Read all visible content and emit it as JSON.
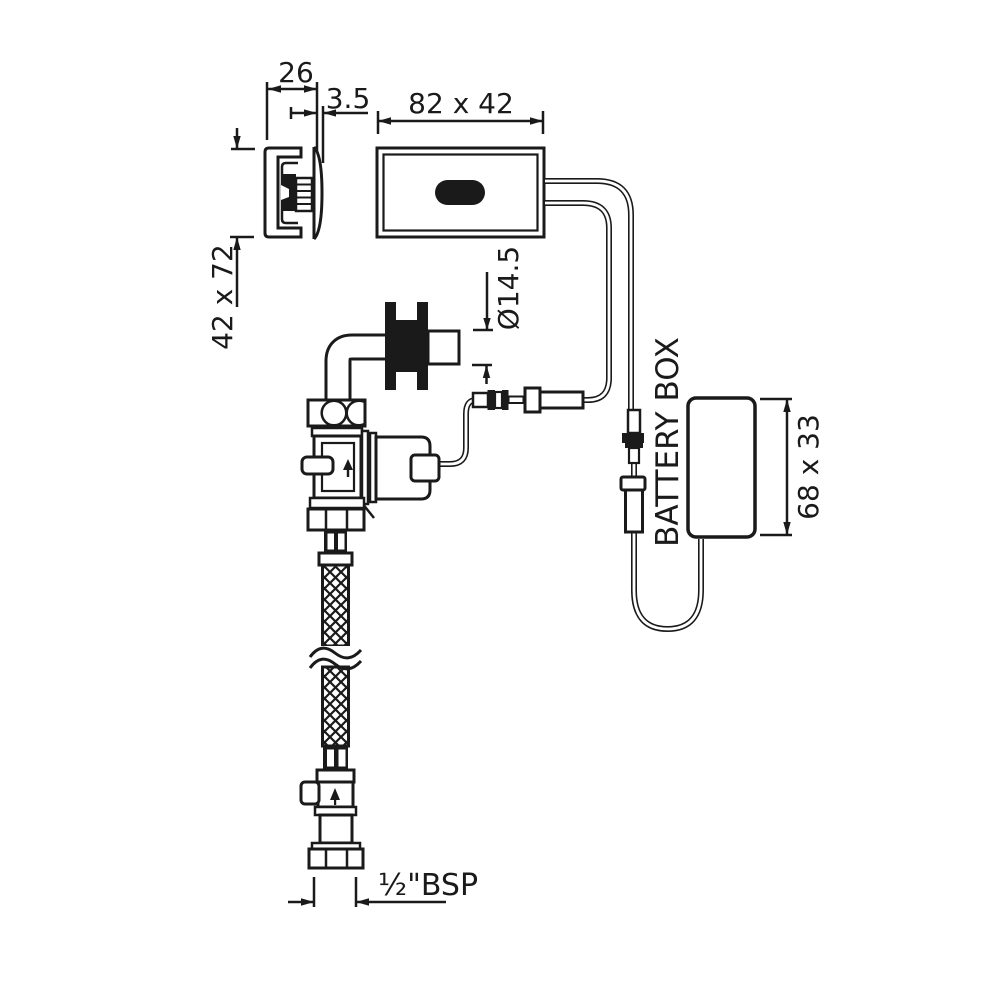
{
  "title": "Sensor flush valve installation drawing",
  "colors": {
    "ink": "#1a1a1a",
    "paper": "#ffffff"
  },
  "dimensions": {
    "bracket_depth": "26",
    "faceplate_thickness": "3.5",
    "sensor_plate": "82 x 42",
    "wall_box": "42 x 72",
    "supply_tube_diameter": "Ø14.5",
    "battery_box_size": "68 x 33",
    "inlet_thread": "½\"BSP"
  },
  "labels": {
    "battery_box": "BATTERY BOX"
  }
}
